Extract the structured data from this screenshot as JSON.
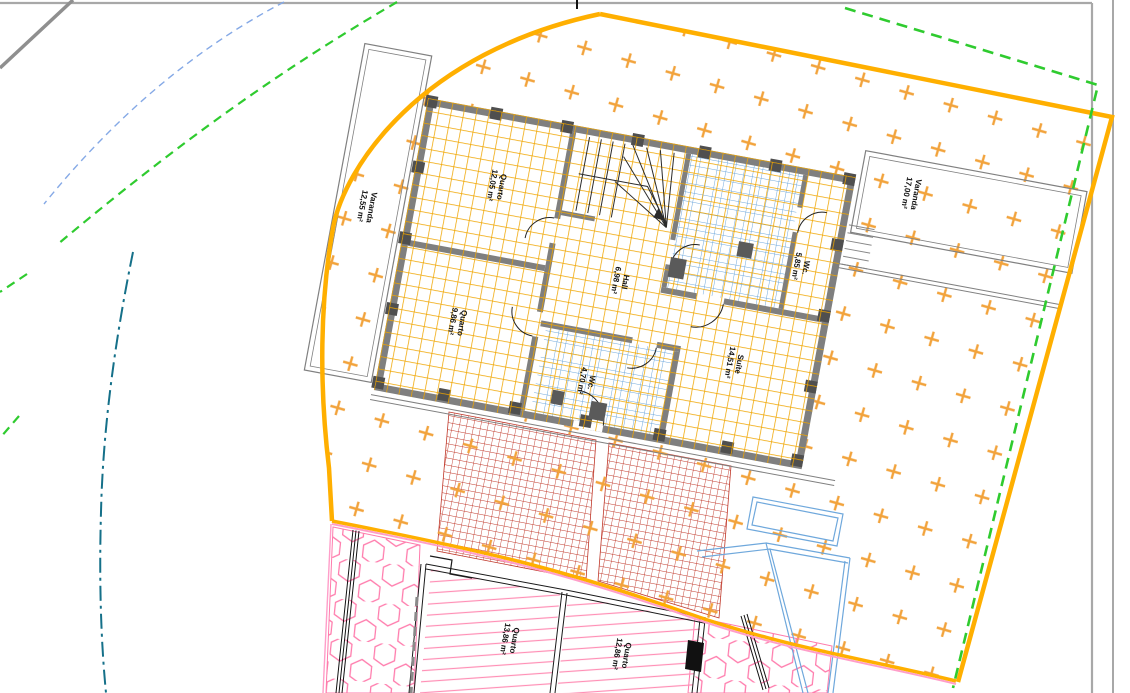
{
  "drawing": {
    "title": "site-floor-plan",
    "rooms": [
      {
        "id": "varanda-left",
        "name": "Varanda",
        "area": "12,55 m²"
      },
      {
        "id": "quarto-top",
        "name": "Quarto",
        "area": "12,05 m²"
      },
      {
        "id": "varanda-right",
        "name": "Varanda",
        "area": "17,00 m²"
      },
      {
        "id": "wc-top",
        "name": "Wc.",
        "area": "5,85 m²"
      },
      {
        "id": "hall",
        "name": "Hall",
        "area": "6,98 m²"
      },
      {
        "id": "quarto-mid",
        "name": "Quarto",
        "area": "9,86 m²"
      },
      {
        "id": "wc-bottom",
        "name": "Wc.",
        "area": "4,70 m²"
      },
      {
        "id": "suite",
        "name": "Suíte",
        "area": "14,51 m²"
      },
      {
        "id": "quarto-lower-left",
        "name": "Quarto",
        "area": "13,86 m²"
      },
      {
        "id": "quarto-lower-right",
        "name": "Quarto",
        "area": "12,86 m²"
      }
    ],
    "colors": {
      "plot_boundary_orange": "#FFAF00",
      "boundary_green_dashed": "#2FCB2F",
      "boundary_pink": "#FF9EC9",
      "site_cross_hatch": "#F2A33C",
      "floor_tile_orange": "#F0A500",
      "bath_tile_blue": "#6FA8DC",
      "paving_brick_red": "#C0392B",
      "hex_hatch_pink": "#FF7BAC",
      "utility_teal_dashdot": "#157089",
      "wall_gray": "#7F7F7F",
      "frame_gray": "#A8A8A8"
    }
  }
}
